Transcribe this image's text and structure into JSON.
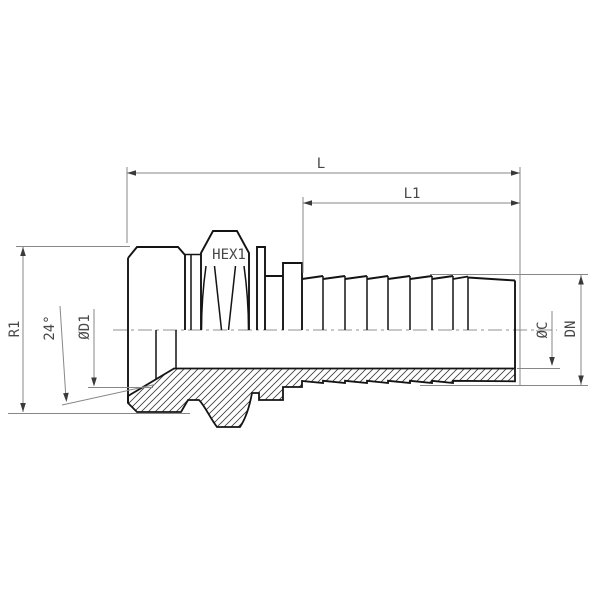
{
  "drawing": {
    "labels": {
      "length_overall": "L",
      "length_tail": "L1",
      "hex_size": "HEX1",
      "radius_r1": "R1",
      "cone_angle": "24°",
      "diameter_d1": "ØD1",
      "diameter_c": "ØC",
      "nominal_dn": "DN"
    },
    "colors": {
      "background": "#ffffff",
      "outline": "#141414",
      "dimension_lines": "#878787",
      "arrowheads": "#3a3a3a",
      "text": "#474747",
      "hatch": "#3c3c3c"
    }
  }
}
